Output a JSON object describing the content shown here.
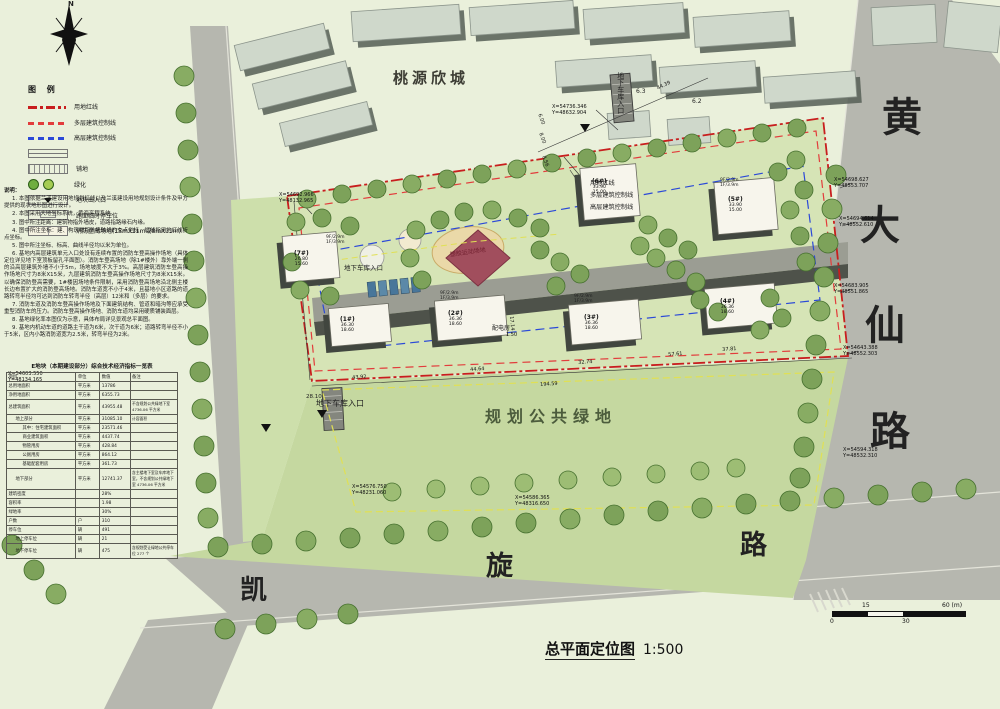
{
  "colors": {
    "background": "#eaf0db",
    "site_green": "#d6e4b6",
    "public_green": "#c5d8a0",
    "road_gray": "#b6b7af",
    "red_line": "#c81e1e",
    "red_dashed": "#e23c3c",
    "blue_dashed": "#2b49d8",
    "yellow_line": "#e0e055",
    "tree_green": "#7da25a",
    "building_white": "#f7f5ec",
    "sports_field": "#a14e5d"
  },
  "legend": {
    "title": "图 例",
    "items": [
      {
        "type": "dashdot-red",
        "label": "用地红线"
      },
      {
        "type": "dash-red",
        "label": "多层建筑控制线"
      },
      {
        "type": "dash-blue",
        "label": "高层建筑控制线"
      },
      {
        "type": "box-line",
        "label": ""
      },
      {
        "type": "hatch",
        "label": "铺地"
      },
      {
        "type": "green",
        "label": "绿化"
      },
      {
        "type": "entrance",
        "label": "地块出入口"
      },
      {
        "type": "parkbox",
        "label": "路面临时停车位"
      },
      {
        "type": "firebox",
        "label": "消防登高场地(15mX11m或8mX11m)"
      }
    ]
  },
  "notes": {
    "title": "说明：",
    "items": [
      "1. 本图依据兰溪建设用地规划红线以及兰溪建设用地规划设计条件及甲方提供的现状地形图进行设计。",
      "2. 本图采用大地坐标系统，黄海高程系统。",
      "3. 图中所注距离：建筑物指外墙皮，道路指路缘石内缘。",
      "4. 图中所注坐标：建、构筑物指外墙轴线的交点坐标，红线指用地红线折点坐标。",
      "5. 图中所注坐标、标高、曲线半径均以米为单位。",
      "6. 基地内高层建筑单元入口处设有连续布置的消防车登高操作场地（具体定位详见地下室顶板留孔平面图）。消防车登高场地（除1#楼外）靠外端一侧的沿高层建筑外墙不小于5m，场地坡度不大于3%。高层建筑消防车登高操作场地尺寸为8米X15米，九层建筑消防车登高操作场地尺寸为8米X15米。以确保消防登高需要，1#楼因场地条件限制，采用消防登高场地沿北侧主楼长边布置扩大的消防登高场地。消防车道宽不小于4米，且基地小区道路的道路转弯半径均可达到消防车转弯半径（高层）12米和（多层）的要求。",
      "7. 消防车道及消防车登高操作场地及下面建筑结构、管道和暗沟等应承受重型消防车的压力。消防车登高操作场地、消防车道均采用硬质铺装面层。",
      "8. 基地绿化率本图仅为示意，具体布局详见景观总平面图。",
      "9. 基地内机动车道的道路主干道为6米，次干道为6米；道路转弯半径不小于5米，区内小路消防道宽为2.5米，转弯半径为2米。"
    ]
  },
  "table": {
    "title": "E地块（本期建设部分）综合技术经济指标一览表",
    "headers": [
      "项目",
      "单位",
      "数值",
      "备注"
    ],
    "rows": [
      {
        "item": "总用地面积",
        "unit": "平方米",
        "value": "13786",
        "note": "",
        "indent": 0
      },
      {
        "item": "净用地面积",
        "unit": "平方米",
        "value": "6355.73",
        "note": "",
        "indent": 0
      },
      {
        "item": "总建筑面积",
        "unit": "平方米",
        "value": "43955.48",
        "note": "不含规划公共绿地下室 4736.06 平方米",
        "indent": 0
      },
      {
        "item": "地上部分",
        "unit": "平方米",
        "value": "31085.10",
        "note": "计容面积",
        "indent": 1
      },
      {
        "item": "其中：住宅建筑面积",
        "unit": "平方米",
        "value": "23571.46",
        "note": "",
        "indent": 2
      },
      {
        "item": "商业建筑面积",
        "unit": "平方米",
        "value": "4437.74",
        "note": "",
        "indent": 2
      },
      {
        "item": "物管用房",
        "unit": "平方米",
        "value": "428.84",
        "note": "",
        "indent": 2
      },
      {
        "item": "公厕用房",
        "unit": "平方米",
        "value": "864.12",
        "note": "",
        "indent": 2
      },
      {
        "item": "基础配套用房",
        "unit": "平方米",
        "value": "361.73",
        "note": "",
        "indent": 2
      },
      {
        "item": "地下部分",
        "unit": "平方米",
        "value": "12741.37",
        "note": "含主楼地下室及车库地下室，不含规划公共绿地下室 4736.06 平方米",
        "indent": 1
      },
      {
        "item": "建筑密度",
        "unit": "",
        "value": "28%",
        "note": "",
        "indent": 0
      },
      {
        "item": "容积率",
        "unit": "",
        "value": "1.98",
        "note": "",
        "indent": 0
      },
      {
        "item": "绿地率",
        "unit": "",
        "value": "30%",
        "note": "",
        "indent": 0
      },
      {
        "item": "户数",
        "unit": "户",
        "value": "310",
        "note": "",
        "indent": 0
      },
      {
        "item": "停车位",
        "unit": "辆",
        "value": "491",
        "note": "",
        "indent": 0
      },
      {
        "item": "地上停车位",
        "unit": "辆",
        "value": "21",
        "note": "",
        "indent": 1
      },
      {
        "item": "地下停车位",
        "unit": "辆",
        "value": "475",
        "note": "含规划受让绿地公共停车位 277 个",
        "indent": 1
      }
    ]
  },
  "plan": {
    "labels": {
      "north": "N",
      "taoyuan": "桃源欣城",
      "public_green": "规划公共绿地",
      "garage": "地下车库入口",
      "sports": "塑胶运动场地",
      "power": "配电房",
      "n63": "6.3",
      "n62": "6.2",
      "elev": "28.10",
      "ctrl_red": "用地红线",
      "ctrl_multi": "多层建筑控制线",
      "ctrl_high": "高层建筑控制线",
      "kai": "凯",
      "xuan": "旋",
      "lu": "路",
      "huang": "黄",
      "da": "大",
      "xian": "仙",
      "floors": "9F/2.9m\n1F/3.9m"
    },
    "coords": [
      {
        "x": "X=54736.346",
        "y": "Y=48632.904"
      },
      {
        "x": "X=54698.627",
        "y": "Y=48553.707"
      },
      {
        "x": "X=54694.614",
        "y": "Y=48552.610"
      },
      {
        "x": "X=54683.905",
        "y": "Y=48551.865"
      },
      {
        "x": "X=54643.388",
        "y": "Y=48552.303"
      },
      {
        "x": "X=54692.966",
        "y": "Y=48132.965"
      },
      {
        "x": "X=54603.550",
        "y": "Y=48134.165"
      },
      {
        "x": "X=54594.318",
        "y": "Y=48532.310"
      },
      {
        "x": "X=54576.750",
        "y": "Y=48231.060"
      },
      {
        "x": "X=54586.365",
        "y": "Y=48316.650"
      }
    ],
    "dims": [
      "43.92",
      "44.64",
      "194.59",
      "32.74",
      "57.61",
      "37.81",
      "44.39",
      "8.56",
      "6.00",
      "8.00",
      "1.50",
      "17.14"
    ],
    "buildings": [
      {
        "name": "(1#)",
        "h1": "36.30",
        "h2": "18.60"
      },
      {
        "name": "(2#)",
        "h1": "36.36",
        "h2": "18.60"
      },
      {
        "name": "(3#)",
        "h1": "36.36",
        "h2": "18.60"
      },
      {
        "name": "(4#)",
        "h1": "36.36",
        "h2": "18.60"
      },
      {
        "name": "(5#)",
        "h1": "33.90",
        "h2": "15.00"
      },
      {
        "name": "(6#)",
        "h1": "33.90",
        "h2": "15.00"
      },
      {
        "name": "(7#)",
        "h1": "26.80",
        "h2": "15.60"
      }
    ]
  },
  "title": {
    "text": "总平面定位图",
    "scale": "1:500"
  },
  "scalebar": {
    "l0": "0",
    "l15": "15",
    "l30": "30",
    "l60": "60 (m)"
  }
}
